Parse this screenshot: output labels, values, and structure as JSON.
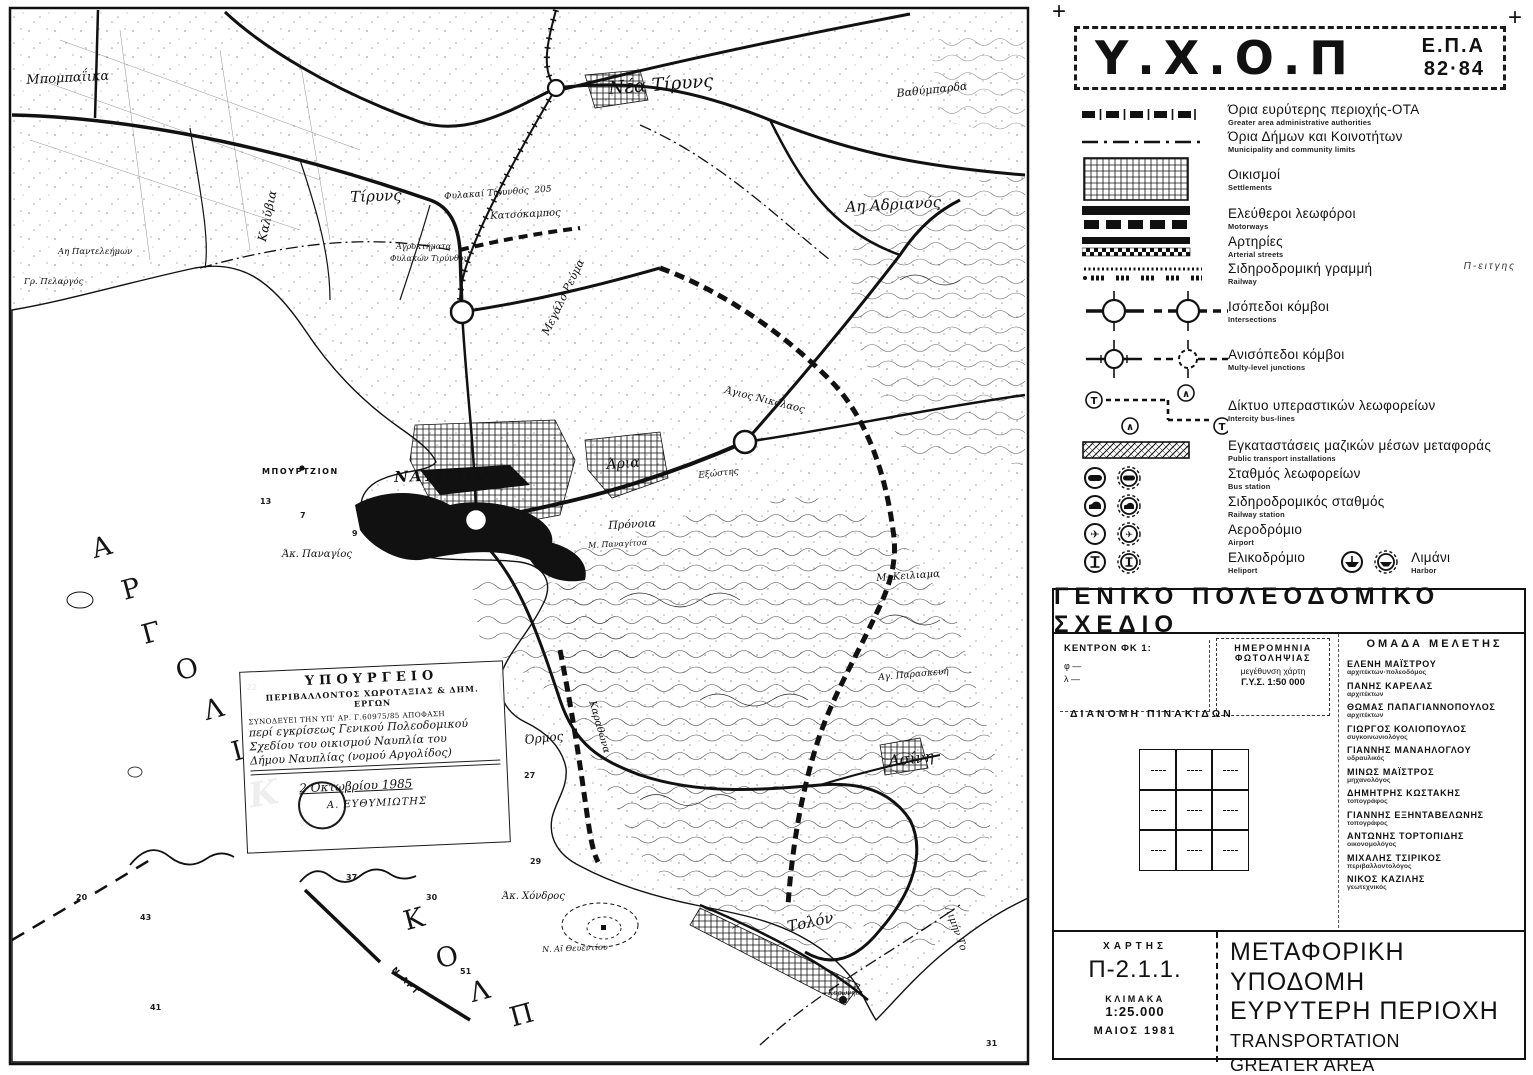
{
  "misc": {
    "reg_mark": "+"
  },
  "header": {
    "title": "Υ.Χ.Ο.Π",
    "epa_line1": "Ε.Π.Α",
    "epa_line2": "82·84"
  },
  "legend": {
    "items": [
      {
        "id": "ota",
        "symbol": "s-ota",
        "gr": "Όρια ευρύτερης περιοχής-ΟΤΑ",
        "en": "Greater area administrative authorities"
      },
      {
        "id": "municipal",
        "symbol": "s-munic",
        "gr": "Όρια Δήμων και Κοινοτήτων",
        "en": "Municipality and community limits"
      },
      {
        "id": "settlements",
        "symbol": "s-settle",
        "gr": "Οικισμοί",
        "en": "Settlements"
      },
      {
        "id": "motorways",
        "symbol": "s-motorway",
        "gr": "Ελεύθεροι λεωφόροι",
        "en": "Motorways"
      },
      {
        "id": "arterial",
        "symbol": "s-arterial",
        "gr": "Αρτηρίες",
        "en": "Arterial streets"
      },
      {
        "id": "railway",
        "symbol": "s-railway",
        "gr": "Σιδηροδρομική γραμμή",
        "en": "Railway",
        "note": "Π-ειτγης"
      },
      {
        "id": "intersections",
        "symbol": "s-isojn",
        "gr": "Ισόπεδοι κόμβοι",
        "en": "Intersections"
      },
      {
        "id": "multilevel",
        "symbol": "s-multijn",
        "gr": "Ανισόπεδοι κόμβοι",
        "en": "Multy-level junctions"
      },
      {
        "id": "intercity-bus",
        "symbol": "s-busline",
        "gr": "Δίκτυο υπεραστικών λεωφορείων",
        "en": "Intercity bus-lines"
      },
      {
        "id": "pt-installations",
        "symbol": "s-ptinstall",
        "gr": "Εγκαταστάσεις μαζικών μέσων μεταφοράς",
        "en": "Public transport installations"
      },
      {
        "id": "bus-station",
        "symbol": "s-busstn",
        "gr": "Σταθμός λεωφορείων",
        "en": "Bus station"
      },
      {
        "id": "railway-station",
        "symbol": "s-railstn",
        "gr": "Σιδηροδρομικός σταθμός",
        "en": "Railway station"
      },
      {
        "id": "airport",
        "symbol": "s-airport",
        "gr": "Αεροδρόμιο",
        "en": "Airport"
      },
      {
        "id": "heliport",
        "symbol": "s-heliport",
        "gr": "Ελικοδρόμιο",
        "en": "Heliport",
        "extra": {
          "symbol": "s-harbor",
          "gr": "Λιμάνι",
          "en": "Harbor"
        }
      }
    ]
  },
  "plan_section": {
    "title": "ΓΕΝΙΚΟ  ΠΟΛΕΟΔΟΜΙΚΟ  ΣΧΕΔΙΟ",
    "kentron": {
      "line1": "ΚΕΝΤΡΟΝ ΦΚ 1:",
      "line2": "φ —",
      "line3": "λ —"
    },
    "photo_box": {
      "l1": "ΗΜΕΡΟΜΗΝΙΑ",
      "l2": "ΦΩΤΟΛΗΨΙΑΣ",
      "l3": "μεγέθυνση χάρτη",
      "l4": "Γ.Υ.Σ.   1:50 000"
    },
    "team": {
      "title": "ΟΜΑΔΑ  ΜΕΛΕΤΗΣ",
      "members": [
        {
          "name": "ΕΛΕΝΗ ΜΑΪΣΤΡΟΥ",
          "role": "αρχιτέκτων·πολεοδόμος"
        },
        {
          "name": "ΠΑΝΗΣ ΚΑΡΕΛΑΣ",
          "role": "αρχιτέκτων"
        },
        {
          "name": "ΘΩΜΑΣ ΠΑΠΑΓΙΑΝΝΟΠΟΥΛΟΣ",
          "role": "αρχιτέκτων"
        },
        {
          "name": "ΓΙΩΡΓΟΣ ΚΟΛΙΟΠΟΥΛΟΣ",
          "role": "συγκοινωνιολόγος"
        },
        {
          "name": "ΓΙΑΝΝΗΣ ΜΑΝΑΗΛΟΓΛΟΥ",
          "role": "υδραυλικός"
        },
        {
          "name": "ΜΙΝΩΣ ΜΑΪΣΤΡΟΣ",
          "role": "μηχανολόγος"
        },
        {
          "name": "ΔΗΜΗΤΡΗΣ ΚΩΣΤΑΚΗΣ",
          "role": "τοπογράφος"
        },
        {
          "name": "ΓΙΑΝΝΗΣ ΕΞΗΝΤΑΒΕΛΩΝΗΣ",
          "role": "τοπογράφος"
        },
        {
          "name": "ΑΝΤΩΝΗΣ ΤΟΡΤΟΠΙΔΗΣ",
          "role": "οικονομολόγος"
        },
        {
          "name": "ΜΙΧΑΛΗΣ ΤΣΙΡΙΚΟΣ",
          "role": "περιβαλλοντολόγος"
        },
        {
          "name": "ΝΙΚΟΣ ΚΑΖΙΛΗΣ",
          "role": "γεωτεχνικός"
        }
      ]
    },
    "dianomi_title": "ΔΙΑΝΟΜΗ  ΠΙΝΑΚΙΔΩΝ"
  },
  "title_block": {
    "chart_label": "ΧΑΡΤΗΣ",
    "chart_no": "Π-2.1.1.",
    "scale_label": "ΚΛΙΜΑΚΑ",
    "scale": "1:25.000",
    "date": "ΜΑΙΟΣ 1981",
    "title_gr1": "ΜΕΤΑΦΟΡΙΚΗ ΥΠΟΔΟΜΗ",
    "title_gr2": "ΕΥΡΥΤΕΡΗ ΠΕΡΙΟΧΗ",
    "title_en1": "TRANSPORTATION",
    "title_en2": "GREATER AREA",
    "region": "ΝΟΜΟΣ  ΑΡΓΟΛΙΔΟΣ"
  },
  "map": {
    "stamp": {
      "l1": "ΥΠΟΥΡΓΕΙΟ",
      "l2": "ΠΕΡΙΒΑΛΛΟΝΤΟΣ ΧΩΡΟΤΑΞΙΑΣ & ΔΗΜ. ΕΡΓΩΝ",
      "l3": "ΣΥΝΟΔΕΥΕΙ ΤΗΝ ΥΠ' ΑΡ. Γ.60975/85 ΑΠΟΦΑΣΗ",
      "l4": "περί εγκρίσεως Γενικού Πολεοδομικού",
      "l5": "Σχεδίου του οικισμού Ναυπλία του",
      "l6": "Δήμου Ναυπλίας (νομού Αργολίδος)",
      "date": "2 Οκτωβρίου 1985",
      "signer": "Α. ΕΥΘΥΜΙΩΤΗΣ"
    },
    "labels": [
      {
        "id": "bobaiika",
        "text": "Μπομπαΐικα",
        "x": 26,
        "y": 74,
        "s": 13,
        "r": -3,
        "c": "it"
      },
      {
        "id": "nea-tiryns",
        "text": "Νέα Τίρυνς",
        "x": 608,
        "y": 80,
        "s": 18,
        "r": -4,
        "c": "it"
      },
      {
        "id": "vathybarda",
        "text": "Βαθύμπαρδα",
        "x": 896,
        "y": 88,
        "s": 11,
        "r": -6,
        "c": "it"
      },
      {
        "id": "tiryns",
        "text": "Τίρυνς",
        "x": 350,
        "y": 190,
        "s": 15,
        "r": -2,
        "c": "it"
      },
      {
        "id": "kalyvia",
        "text": "Καλύβια",
        "x": 256,
        "y": 240,
        "s": 12,
        "r": -78,
        "c": "it"
      },
      {
        "id": "ai-adrianos",
        "text": "Αη Αδριανός",
        "x": 845,
        "y": 200,
        "s": 15,
        "r": -3,
        "c": "it"
      },
      {
        "id": "megalo-revma",
        "text": "Μεγάλο Ρεύμα",
        "x": 540,
        "y": 332,
        "s": 11,
        "r": -64,
        "c": "it"
      },
      {
        "id": "ai-panteleimon",
        "text": "Αη Παντελεήμων",
        "x": 58,
        "y": 248,
        "s": 8.5,
        "r": 0,
        "c": "it"
      },
      {
        "id": "gr-pelargos",
        "text": "Γρ. Πελαργός",
        "x": 24,
        "y": 278,
        "s": 8.5,
        "r": 0,
        "c": "it"
      },
      {
        "id": "fylakai-tirynthos",
        "text": "Φυλακαί Τίρυνθος  205",
        "x": 444,
        "y": 193,
        "s": 9,
        "r": -4,
        "c": "it"
      },
      {
        "id": "katsokampos",
        "text": "Κατσόκαμπος",
        "x": 490,
        "y": 212,
        "s": 10,
        "r": -3,
        "c": "it"
      },
      {
        "id": "agroktimata",
        "text": "Αγροκτήματα",
        "x": 396,
        "y": 243,
        "s": 8,
        "r": 0,
        "c": "it"
      },
      {
        "id": "fylakon-tirynthou",
        "text": "Φυλακών Τιρύνθου",
        "x": 390,
        "y": 255,
        "s": 8,
        "r": 0,
        "c": "it"
      },
      {
        "id": "bourtzion",
        "text": "ΜΠΟΥΡΤΖΙΟΝ",
        "x": 262,
        "y": 468,
        "s": 8,
        "r": 0,
        "c": "sp"
      },
      {
        "id": "nafplio",
        "text": "ΝΑΥΠΛΙΟ",
        "x": 394,
        "y": 470,
        "s": 15,
        "r": -2,
        "c": "cap"
      },
      {
        "id": "aria",
        "text": "Άρια",
        "x": 606,
        "y": 458,
        "s": 14,
        "r": -4,
        "c": "it"
      },
      {
        "id": "pronoia",
        "text": "Πρόνοια",
        "x": 608,
        "y": 520,
        "s": 11,
        "r": -3,
        "c": "it"
      },
      {
        "id": "agios-nikolaos",
        "text": "Άγιος Νικόλαος",
        "x": 726,
        "y": 386,
        "s": 10,
        "r": 14,
        "c": "it"
      },
      {
        "id": "exostis",
        "text": "Εξώστης",
        "x": 698,
        "y": 472,
        "s": 9,
        "r": -6,
        "c": "it"
      },
      {
        "id": "m-panagitsa",
        "text": "Μ. Παναγίτσα",
        "x": 588,
        "y": 542,
        "s": 8,
        "r": -3,
        "c": "it"
      },
      {
        "id": "m-keiliama",
        "text": "Μ. Κειλιαμα",
        "x": 876,
        "y": 574,
        "s": 10,
        "r": -4,
        "c": "it"
      },
      {
        "id": "ak-panagios",
        "text": "Άκ. Παναγίος",
        "x": 282,
        "y": 550,
        "s": 10,
        "r": 0,
        "c": "it"
      },
      {
        "id": "ormos",
        "text": "Όρμος",
        "x": 524,
        "y": 734,
        "s": 12,
        "r": -6,
        "c": "it"
      },
      {
        "id": "karathona",
        "text": "Καραθώνα",
        "x": 596,
        "y": 700,
        "s": 10,
        "r": 74,
        "c": "it"
      },
      {
        "id": "ag-paraskevi",
        "text": "Αγ. Παρασκευή",
        "x": 878,
        "y": 674,
        "s": 9,
        "r": -5,
        "c": "it"
      },
      {
        "id": "asini",
        "text": "Ασίνη",
        "x": 888,
        "y": 754,
        "s": 15,
        "r": -6,
        "c": "it"
      },
      {
        "id": "ak-chondros",
        "text": "Άκ. Χόνδρος",
        "x": 502,
        "y": 892,
        "s": 10,
        "r": 0,
        "c": "it"
      },
      {
        "id": "ai-theventiou",
        "text": "Ν. Αϊ Θευεντίου",
        "x": 542,
        "y": 946,
        "s": 8,
        "r": -2,
        "c": "it"
      },
      {
        "id": "tolon",
        "text": "Τολόν",
        "x": 786,
        "y": 920,
        "s": 15,
        "r": -12,
        "c": "it"
      },
      {
        "id": "limin-tolou",
        "text": "Λιμήν Το",
        "x": 952,
        "y": 906,
        "s": 10,
        "r": 70,
        "c": "it"
      },
      {
        "id": "koronisi",
        "text": "Κορωνήσι",
        "x": 828,
        "y": 990,
        "s": 7,
        "r": 0,
        "c": "it"
      },
      {
        "id": "n-art",
        "text": "Ν.ΑΡΤ",
        "x": 396,
        "y": 966,
        "s": 8,
        "r": 46,
        "c": "sp"
      },
      {
        "id": "k-script",
        "text": "Κ",
        "x": 246,
        "y": 780,
        "s": 34,
        "r": -10,
        "c": "script"
      }
    ],
    "sea_letters": [
      {
        "ch": "Α",
        "x": 92,
        "y": 534
      },
      {
        "ch": "Ρ",
        "x": 122,
        "y": 576
      },
      {
        "ch": "Γ",
        "x": 142,
        "y": 620
      },
      {
        "ch": "Ο",
        "x": 176,
        "y": 656
      },
      {
        "ch": "Λ",
        "x": 204,
        "y": 696
      },
      {
        "ch": "Ι",
        "x": 232,
        "y": 738
      },
      {
        "ch": "Κ",
        "x": 404,
        "y": 906
      },
      {
        "ch": "Ο",
        "x": 436,
        "y": 944
      },
      {
        "ch": "Λ",
        "x": 470,
        "y": 978
      },
      {
        "ch": "Π",
        "x": 510,
        "y": 1002
      }
    ],
    "depths": [
      {
        "v": "13",
        "x": 260,
        "y": 498
      },
      {
        "v": "9",
        "x": 352,
        "y": 530
      },
      {
        "v": "7",
        "x": 300,
        "y": 512
      },
      {
        "v": "22",
        "x": 246,
        "y": 684
      },
      {
        "v": "27",
        "x": 524,
        "y": 772
      },
      {
        "v": "24",
        "x": 300,
        "y": 820
      },
      {
        "v": "20",
        "x": 76,
        "y": 894
      },
      {
        "v": "30",
        "x": 426,
        "y": 894
      },
      {
        "v": "43",
        "x": 140,
        "y": 914
      },
      {
        "v": "37",
        "x": 346,
        "y": 874
      },
      {
        "v": "29",
        "x": 530,
        "y": 858
      },
      {
        "v": "41",
        "x": 150,
        "y": 1004
      },
      {
        "v": "51",
        "x": 460,
        "y": 968
      },
      {
        "v": "31",
        "x": 986,
        "y": 1040
      }
    ]
  }
}
